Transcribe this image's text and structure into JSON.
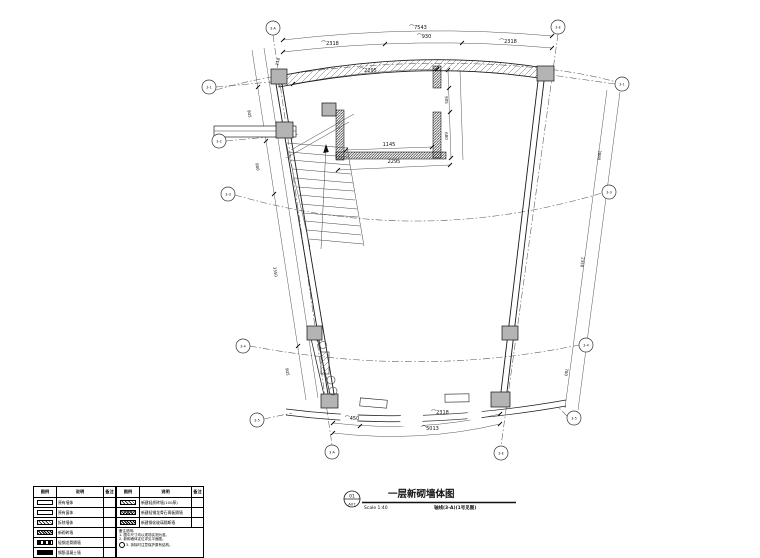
{
  "title_block": {
    "detail_number": "01",
    "sheet_number": "A07",
    "title": "一层新砌墙体图",
    "scale": "Scale 1:40",
    "note": "轴线(3-A)(1号见图)"
  },
  "grid_bubbles": [
    {
      "id": "top-left",
      "label": "3-A"
    },
    {
      "id": "top-right",
      "label": "3-E"
    },
    {
      "id": "left-1",
      "label": "3-1"
    },
    {
      "id": "left-2",
      "label": "3-2"
    },
    {
      "id": "left-3",
      "label": "3-3"
    },
    {
      "id": "left-4",
      "label": "3-4"
    },
    {
      "id": "left-5",
      "label": "3-5"
    },
    {
      "id": "right-1",
      "label": "3-1"
    },
    {
      "id": "right-2",
      "label": "3-3"
    },
    {
      "id": "right-3",
      "label": "3-4"
    },
    {
      "id": "right-4",
      "label": "3-5"
    },
    {
      "id": "bottom-left",
      "label": "3-A"
    },
    {
      "id": "bottom-right",
      "label": "3-E"
    }
  ],
  "dimensions": {
    "top_total": "⌒7543",
    "top_seg_left": "⌒2318",
    "top_seg_mid": "⌒930",
    "top_seg_right": "⌒2318",
    "top_inner": "⌒2295",
    "top_small": "118",
    "room_width_inner": "1145",
    "room_width_outer": "2295",
    "room_height_upper": "905",
    "room_height_lower": "680",
    "bottom_seg_left": "⌒450",
    "bottom_seg_mid": "⌒2318",
    "bottom_total": "⌒5013",
    "left_chain_1": "905",
    "left_chain_2": "980",
    "left_chain_3": "3350",
    "left_chain_4": "905",
    "right_chain_1": "3880",
    "right_chain_2": "2350",
    "right_chain_3": "780"
  },
  "legend": {
    "headers": {
      "swatch": "图例",
      "description": "说明",
      "remark": "备注"
    },
    "left_rows": [
      {
        "swatch": "outline-wall",
        "description": "原有墙体"
      },
      {
        "swatch": "outline-window",
        "description": "原有窗体"
      },
      {
        "swatch": "diagonal-hatch",
        "description": "拆除墙体"
      },
      {
        "swatch": "dense-hatch",
        "description": "新砌砖墙"
      },
      {
        "swatch": "dash-pattern",
        "description": "轻钢龙骨隔墙"
      },
      {
        "swatch": "solid-black",
        "description": "钢筋混凝土墙"
      }
    ],
    "right_rows": [
      {
        "swatch": "diagonal-hatch",
        "description": "新建轻质砖墙(100厚)"
      },
      {
        "swatch": "cross-hatch",
        "description": "新建轻钢龙骨石膏板隔墙"
      },
      {
        "swatch": "dense-hatch",
        "description": "新建钢化玻璃隔断墙"
      }
    ],
    "notes_title": "备注说明:",
    "notes": [
      "1. 图中尺寸均以现场实测为准。",
      "2. 新砌墙体定位详见平面图。",
      "3. 拆除时注意保护原有结构。"
    ]
  },
  "colors": {
    "line": "#1a1a1a",
    "column_fill": "#b4b4b4",
    "background": "#ffffff"
  }
}
